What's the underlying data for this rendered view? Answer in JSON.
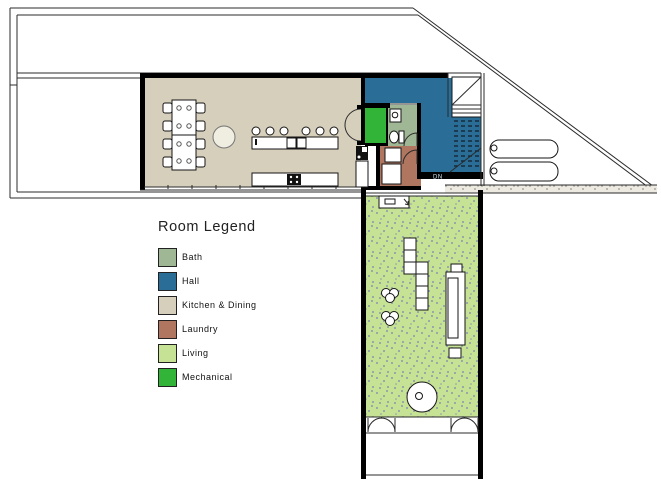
{
  "legend": {
    "title": "Room Legend",
    "items": [
      {
        "label": "Bath",
        "color": "#A0B795"
      },
      {
        "label": "Hall",
        "color": "#2A6D96"
      },
      {
        "label": "Kitchen & Dining",
        "color": "#D6CFBC"
      },
      {
        "label": "Laundry",
        "color": "#B07660"
      },
      {
        "label": "Living",
        "color": "#C6E295"
      },
      {
        "label": "Mechanical",
        "color": "#31B437"
      }
    ]
  },
  "plan": {
    "stair_label": "DN"
  }
}
